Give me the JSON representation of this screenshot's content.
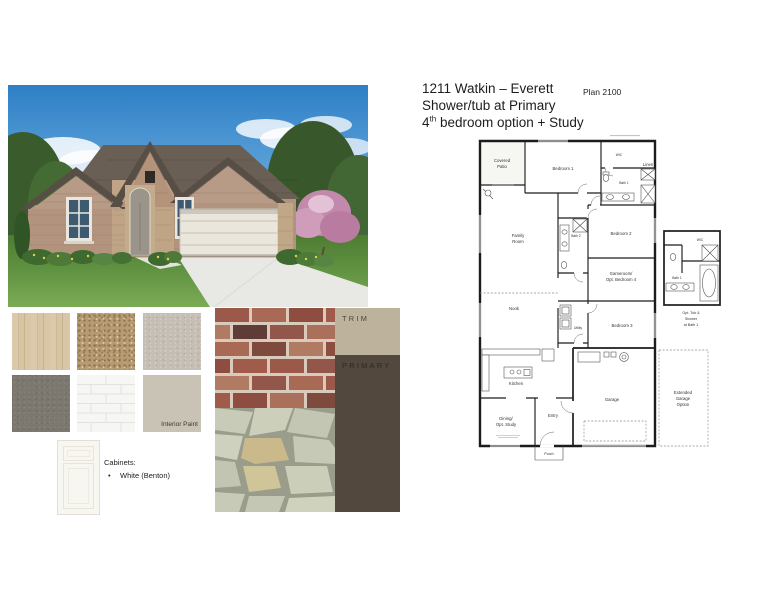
{
  "header": {
    "line1": "1211 Watkin – Everett",
    "line2": "Shower/tub at Primary",
    "line3_num": "4",
    "line3_sup": "th",
    "line3_rest": " bedroom option + Study",
    "plan_badge": "Plan 2100"
  },
  "materials": {
    "interior_paint_label": "Interior Paint",
    "cabinets_heading": "Cabinets:",
    "bullet": "•",
    "cabinets_item": "White (Benton)",
    "trim_label": "TRIM",
    "primary_label": "PRIMARY",
    "swatch_names": [
      "wood-flooring",
      "carpet",
      "stone-texture",
      "dark-gray-flooring",
      "subway-tile",
      "interior-paint",
      "white-cabinet-door",
      "brick",
      "flagstone"
    ],
    "colors": {
      "trim_bg": "#bdb29c",
      "primary_bg": "#52483e",
      "interior_paint": "#c9c3b5",
      "cabinet": "#f8f6f1"
    }
  },
  "floor_plan": {
    "labels": {
      "covered_patio": [
        "Covered",
        "Patio"
      ],
      "bedroom1": "Bedroom 1",
      "wic": "WIC",
      "linen": "Linen",
      "bath1": "Bath 1",
      "bath2": "Bath 2",
      "bedroom2": "Bedroom 2",
      "family_room": [
        "Family",
        "Room"
      ],
      "gameroom": [
        "Gameroom/",
        "Opt. Bedroom 4"
      ],
      "nook": "Nook",
      "bedroom3": "Bedroom 3",
      "utility": "Utility",
      "kitchen": "Kitchen",
      "dining": [
        "Dining/",
        "Opt. Study"
      ],
      "entry": "Entry",
      "porch": "Porch",
      "garage": "Garage",
      "extended_garage": [
        "Extended",
        "Garage",
        "Option"
      ],
      "inset_wic": "WIC",
      "inset_bath1": "Bath 1",
      "inset_caption": [
        "Opt. Tub &",
        "Shower",
        "at Bath 1"
      ]
    }
  }
}
